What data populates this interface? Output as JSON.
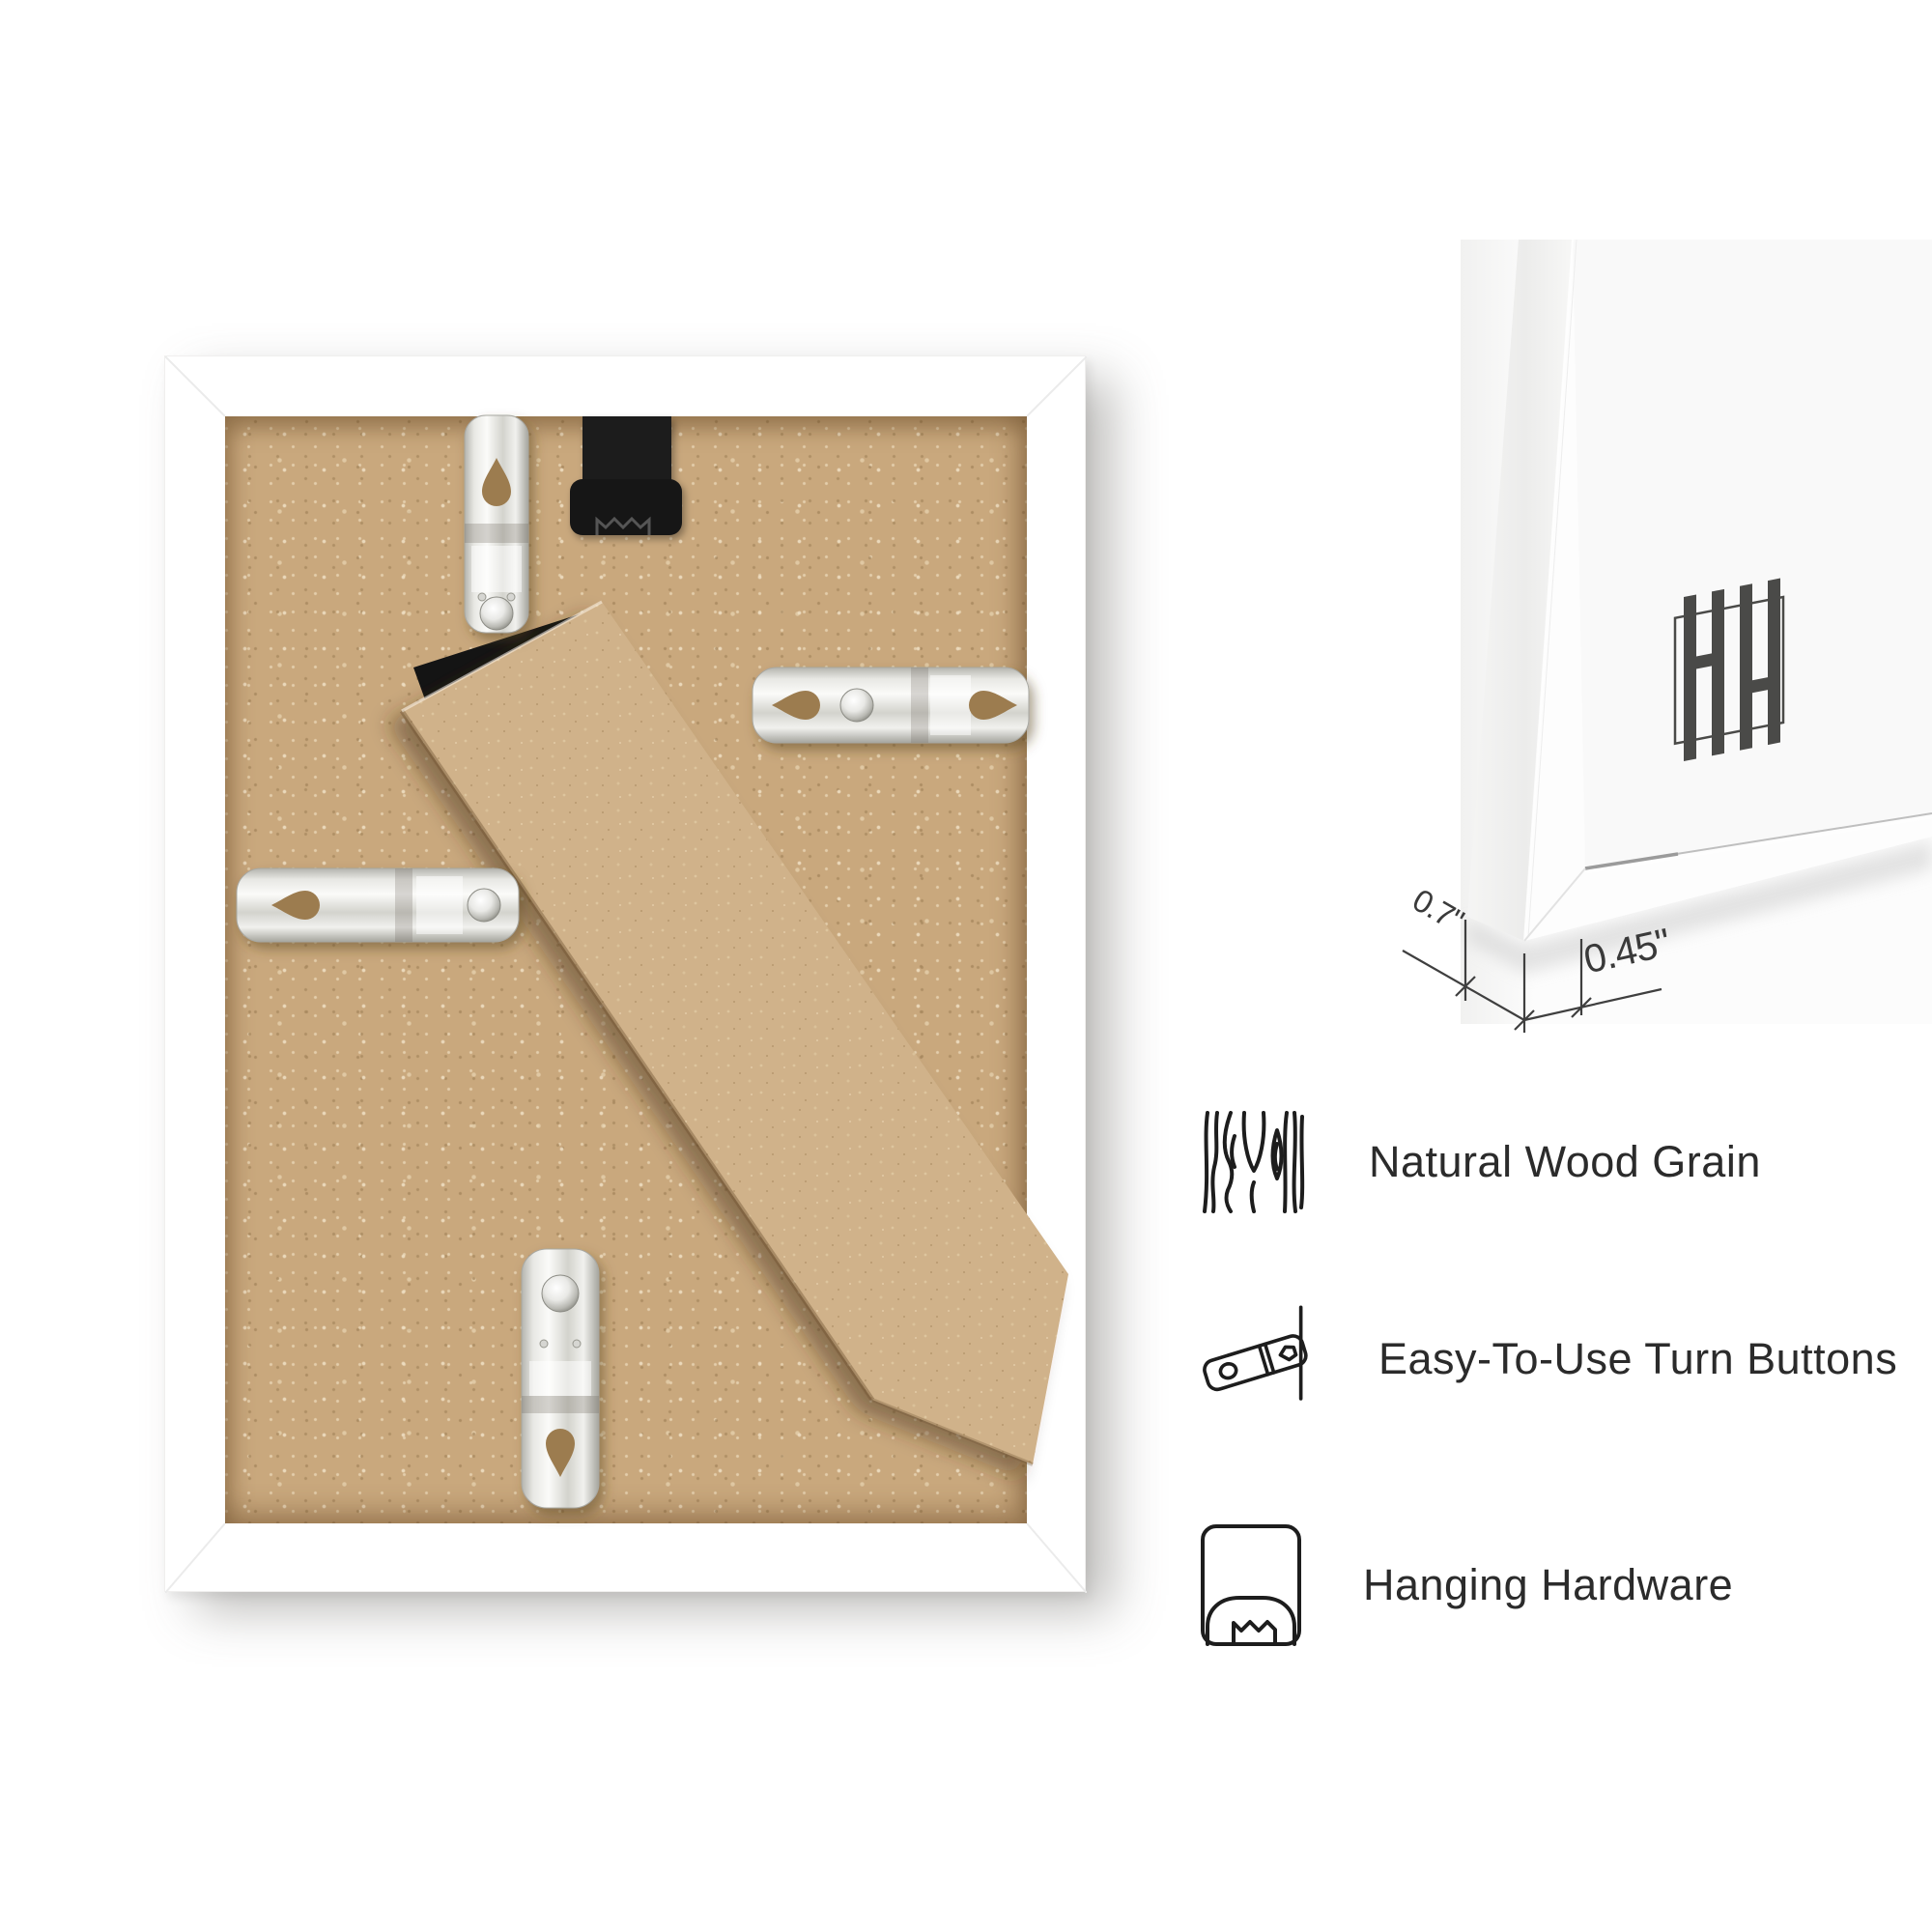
{
  "dimensions": {
    "frame_depth": "0.7\"",
    "frame_face_width": "0.45\""
  },
  "features": [
    {
      "icon": "wood-grain-icon",
      "label": "Natural Wood Grain"
    },
    {
      "icon": "turn-button-icon",
      "label": "Easy-To-Use Turn Buttons"
    },
    {
      "icon": "hanging-hardware-icon",
      "label": "Hanging Hardware"
    }
  ],
  "brand_monogram": "HH",
  "photos": {
    "back_view": "frame-back-photo",
    "corner_view": "frame-corner-close-up-photo"
  },
  "colors": {
    "background": "#ffffff",
    "frame": "#ffffff",
    "mdf_backing": "#c9a87d",
    "easel_board": "#d0b28a",
    "hanger_tab": "#1f1f1f",
    "metal_clip": "#e8e8e4",
    "logo": "#4a4a48",
    "dimension_lines": "#3f3f3f",
    "feature_text": "#2b2b2b"
  }
}
